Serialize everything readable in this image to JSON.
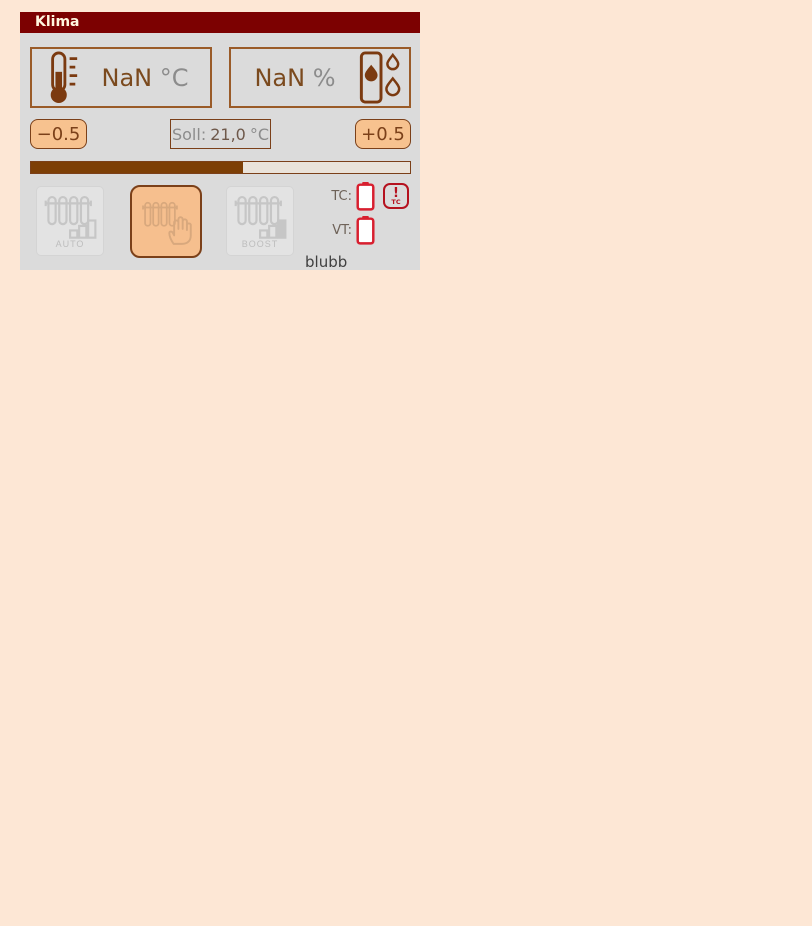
{
  "card": {
    "title": "Klima",
    "temperature": {
      "value": "NaN",
      "unit": "°C"
    },
    "humidity": {
      "value": "NaN",
      "unit": "%"
    },
    "setpoint": {
      "decrease_label": "−0.5",
      "label_prefix": "Soll:",
      "value": "21,0",
      "unit": "°C",
      "increase_label": "+0.5"
    },
    "progress": {
      "percent": 56
    },
    "modes": [
      {
        "id": "auto",
        "label": "AUTO",
        "active": false
      },
      {
        "id": "manual",
        "label": "",
        "active": true
      },
      {
        "id": "boost",
        "label": "BOOST",
        "active": false
      }
    ],
    "status": {
      "tc_label": "TC:",
      "vt_label": "VT:",
      "warning_text": "!",
      "warning_sub": "TC"
    },
    "footer": "blubb"
  },
  "colors": {
    "page_background": "#fde7d5",
    "card_background": "#dbdbdb",
    "header_background": "#7c0101",
    "header_text": "#fff6df",
    "accent_brown": "#7b4019",
    "value_brown": "#7b4a1e",
    "muted_gray": "#8c8c8c",
    "button_peach": "#f7c28f",
    "active_mode_peach": "#f6bf8e",
    "progress_fill": "#7d3f06",
    "battery_red": "#d81f2f",
    "warning_red": "#b5121f",
    "disabled_gray": "#c6c6c6"
  }
}
